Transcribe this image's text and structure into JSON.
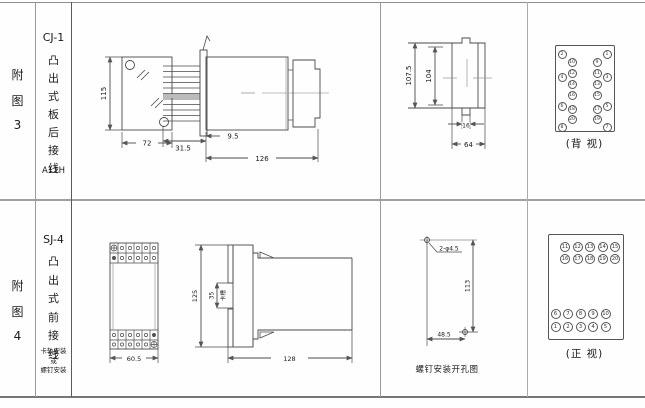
{
  "fig3": {
    "row_label": [
      "附",
      "图",
      "3"
    ],
    "model": "CJ-1",
    "title": [
      "凸",
      "出",
      "式",
      "板",
      "后",
      "接",
      "线"
    ],
    "code": "A11H",
    "dims": {
      "front_h": "115",
      "front_w": "72",
      "pin_len": "31.5",
      "flange_off": "9.5",
      "depth": "126",
      "side_h": "107.5",
      "side_inner_h": "104",
      "tab_w": "16",
      "side_w": "64"
    },
    "back_view": {
      "caption": "(背 视)",
      "outer_left": [
        "2",
        "4",
        "6",
        "8"
      ],
      "inner_left": [
        "10",
        "12",
        "14",
        "16",
        "18",
        "20"
      ],
      "inner_right": [
        "9",
        "11",
        "13",
        "15",
        "17",
        "19"
      ],
      "outer_right": [
        "1",
        "3",
        "5",
        "7"
      ]
    }
  },
  "fig4": {
    "row_label": [
      "附",
      "图",
      "4"
    ],
    "model": "SJ-4",
    "title": [
      "凸",
      "出",
      "式",
      "前",
      "接",
      "线"
    ],
    "mount_note": [
      "卡轨安装",
      "或",
      "螺钉安装"
    ],
    "dims": {
      "front_w": "60.5",
      "front_h": "125",
      "slot": "35",
      "slot_label": "卡槽",
      "depth": "128",
      "holes": "2-φ4.5",
      "hole_dist_v": "113",
      "hole_dist_h": "48.5"
    },
    "hole_caption": "螺钉安装开孔图",
    "front_view": {
      "caption": "(正 视)",
      "rows": [
        [
          "11",
          "12",
          "13",
          "14",
          "15"
        ],
        [
          "16",
          "17",
          "18",
          "19",
          "20"
        ],
        [
          "6",
          "7",
          "8",
          "9",
          "10"
        ],
        [
          "1",
          "2",
          "3",
          "4",
          "5"
        ]
      ]
    }
  }
}
